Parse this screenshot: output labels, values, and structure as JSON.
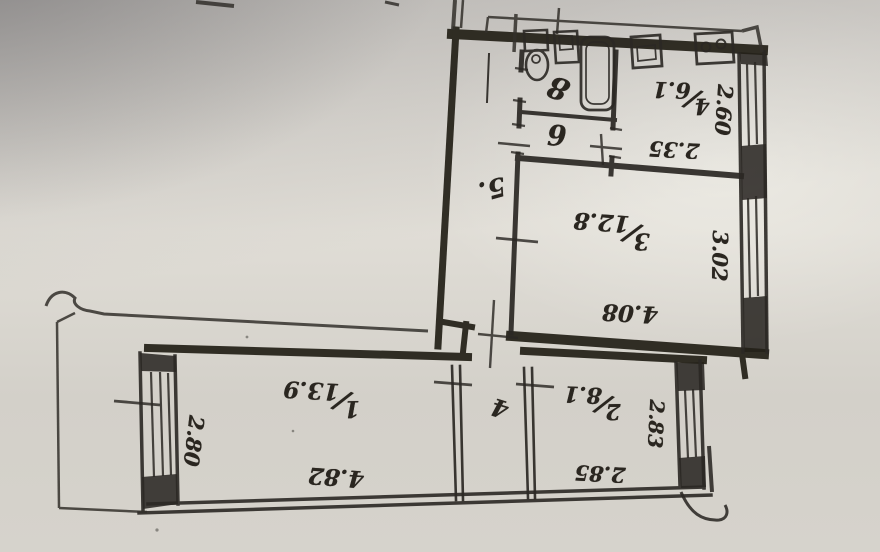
{
  "page": {
    "kind": "photographed hand-drawn apartment floor plan (BTI style)",
    "ink_color": "#2a2620",
    "paper_shadow_color": "#a09ea2",
    "paper_light_color": "#e3e0d9",
    "fraction_separator": "/"
  },
  "plan": {
    "rooms": [
      {
        "name": "room-1",
        "number": "1",
        "area": "13.9",
        "width": "4.82",
        "depth": "2.80"
      },
      {
        "name": "room-2",
        "number": "2",
        "area": "8.1",
        "width": "2.85",
        "depth": "2.83"
      },
      {
        "name": "room-3",
        "number": "3",
        "area": "12.8",
        "width": "4.08",
        "depth": "3.02"
      },
      {
        "name": "kitchen",
        "number": "4",
        "area": "6.1",
        "width": "2.35",
        "depth": "2.60"
      },
      {
        "name": "corridor",
        "number": "5."
      },
      {
        "name": "wc",
        "number": "6"
      },
      {
        "name": "hall",
        "number": "4"
      },
      {
        "name": "bathroom",
        "number": "8"
      }
    ],
    "fixtures": [
      "toilet",
      "wash-sink",
      "bathtub",
      "kitchen-sink",
      "stove"
    ]
  }
}
